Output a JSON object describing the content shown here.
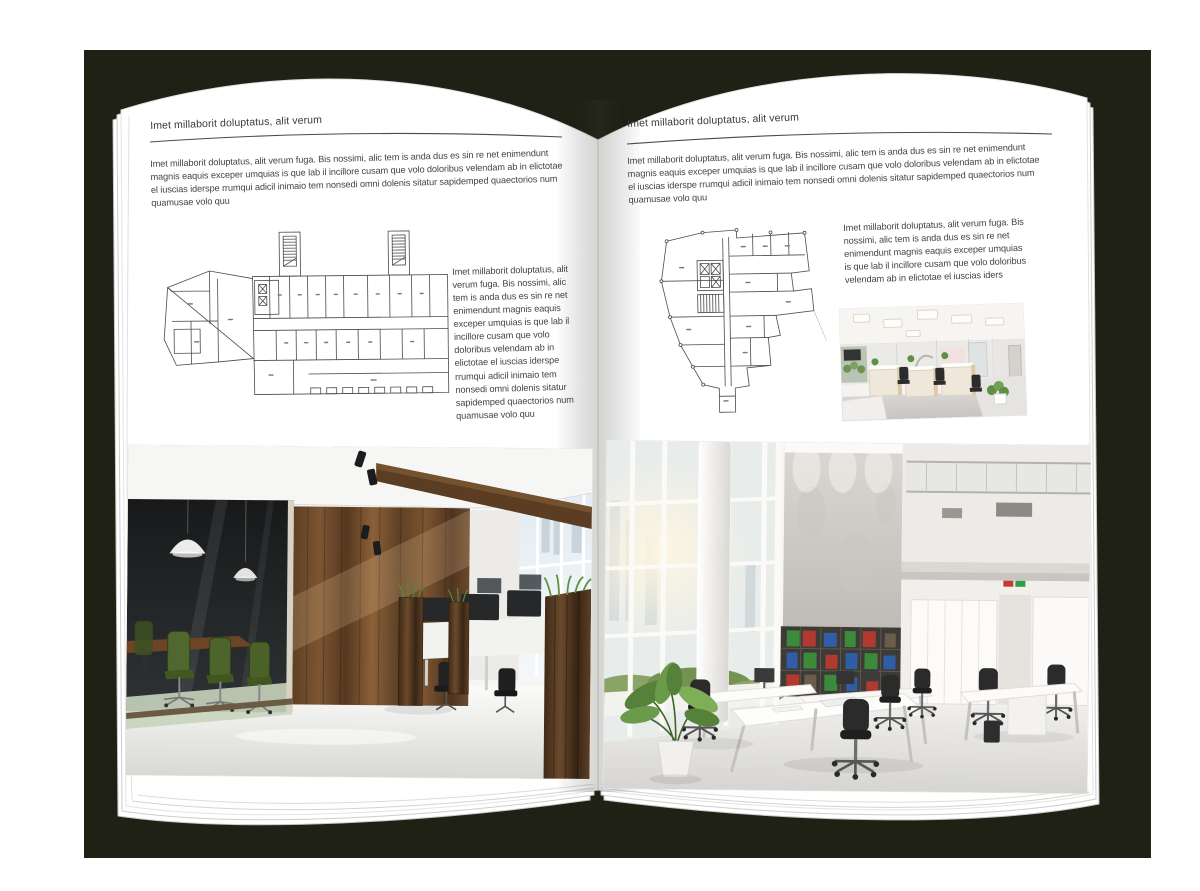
{
  "palette": {
    "backdrop": "#1f2114",
    "page": "#ffffff",
    "ink": "#3d3d3d",
    "rule": "#4a4a4a",
    "wood": "#6b4a2c",
    "chair-green": "#50682e",
    "plant-green": "#5d8f46",
    "binder-green": "#3c8a3c",
    "binder-red": "#b03a30",
    "binder-blue": "#2f5ea6"
  },
  "left_page": {
    "header": "Imet millaborit doluptatus, alit verum",
    "intro": "Imet millaborit doluptatus, alit verum fuga. Bis nossimi, alic tem is anda dus es sin re net enimendunt magnis eaquis exceper umquias is que lab il incillore cusam que volo doloribus velendam ab in elictotae el iuscias iderspe rrumqui adicil inimaio tem nonsedi omni dolenis sitatur sapidemped quaectorios num quamusae volo quu",
    "side_text": "Imet millaborit doluptatus, alit verum fuga. Bis nossimi, alic tem is anda dus es sin re net enimendunt magnis eaquis exceper umquias is que lab il incillore cusam que volo doloribus velendam ab in elictotae el iuscias iderspe rrumqui adicil inimaio tem nonsedi omni dolenis sitatur sapidemped quaectorios num quamusae volo quu",
    "floor_plan": "wide-building-floor-plan-with-two-stair-towers",
    "photo": "office-interior-dark-glass-meeting-room-wood-wall"
  },
  "right_page": {
    "header": "Imet millaborit doluptatus, alit verum",
    "intro": "Imet millaborit doluptatus, alit verum fuga. Bis nossimi, alic tem is anda dus es sin re net enimendunt magnis eaquis exceper umquias is que lab il incillore cusam que volo doloribus velendam ab in elictotae el iuscias iderspe rrumqui adicil inimaio tem nonsedi omni dolenis sitatur sapidemped quaectorios num quamusae volo quu",
    "side_text": "Imet millaborit doluptatus, alit verum fuga. Bis nossimi, alic tem is anda dus es sin re net enimendunt magnis eaquis exceper umquias is que lab il incillore cusam que volo doloribus velendam ab in elictotae el iuscias iders",
    "floor_plan": "irregular-tower-floor-plan-with-bottom-stem",
    "photo_small": "open-office-cubicles-white-beige",
    "photo_large": "bright-loft-office-mezzanine-bookshelves"
  }
}
